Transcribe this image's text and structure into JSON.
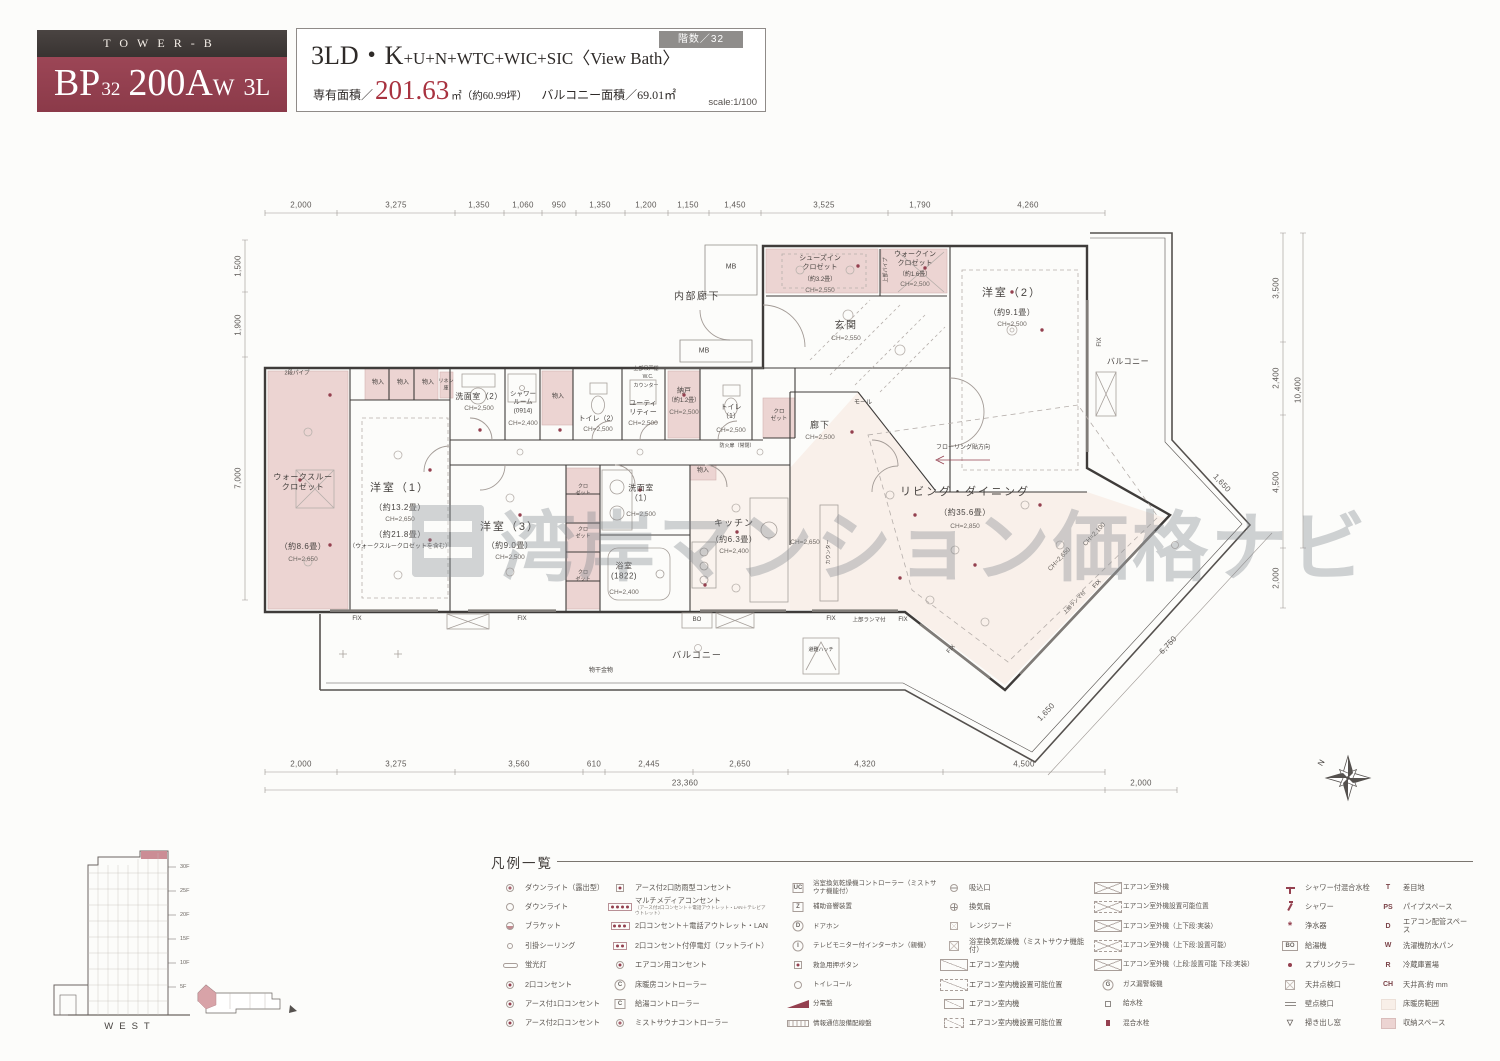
{
  "header": {
    "tower": "TOWER-B",
    "unit_model": "BP",
    "unit_floor": "32",
    "unit_number": "200A",
    "unit_suffix": "W",
    "unit_plan": "3L",
    "floors_badge": "階数／32",
    "title_main": "3LD・K",
    "title_rest": "+U+N+WTC+WIC+SIC",
    "title_view": "〈View Bath〉",
    "area_label": "専有面積／",
    "area_value": "201.63",
    "area_unit": "㎡（約60.99坪）",
    "balcony_area": "バルコニー面積／69.01㎡",
    "scale": "scale:1/100"
  },
  "plan": {
    "watermark": "湾岸マンション価格ナビ",
    "compass_n": "N",
    "rooms": {
      "walkthrough": {
        "name": "ウォークスルー\nクロゼット",
        "size": "（約8.6畳）",
        "ch": "CH=2,650"
      },
      "bed1": {
        "name": "洋室（1）",
        "size": "（約13.2畳）",
        "ch": "CH=2,650",
        "size2": "（約21.8畳）",
        "note": "（ウォークスルークロゼットを含む）"
      },
      "bed2": {
        "name": "洋室（2）",
        "size": "（約9.1畳）",
        "ch": "CH=2,500"
      },
      "bed3": {
        "name": "洋室（3）",
        "size": "（約9.0畳）",
        "ch": "CH=2,500"
      },
      "wash2": {
        "name": "洗面室（2）",
        "ch": "CH=2,500"
      },
      "shower": {
        "name": "シャワー\nルーム\n(0914)",
        "ch": "CH=2,400"
      },
      "toilet2": {
        "name": "トイレ（2）",
        "ch": "CH=2,500"
      },
      "utility": {
        "name": "ユーティ\nリティー",
        "ch": "CH=2,500"
      },
      "storeroom": {
        "name": "納戸",
        "size": "（約1.2畳）",
        "ch": "CH=2,500"
      },
      "toilet1": {
        "name": "トイレ\n（1）",
        "ch": "CH=2,500"
      },
      "wash1": {
        "name": "洗面室\n（1）",
        "ch": "CH=2,500"
      },
      "bath": {
        "name": "浴室\n(1822)",
        "ch": "CH=2,400"
      },
      "kitchen": {
        "name": "キッチン",
        "size": "（約6.3畳）",
        "ch": "CH=2,400"
      },
      "living": {
        "name": "リビング・ダイニング",
        "size": "（約35.6畳）",
        "ch": "CH=2,850"
      },
      "entrance": {
        "name": "玄関",
        "ch": "CH=2,550"
      },
      "corridor": {
        "name": "廊下",
        "ch": "CH=2,500"
      },
      "inner_corridor": {
        "name": "内部廊下"
      },
      "shoes": {
        "name": "シューズイン\nクロゼット",
        "size": "（約3.2畳）",
        "ch": "CH=2,550"
      },
      "wic": {
        "name": "ウォークイン\nクロゼット",
        "size": "（約1.6畳）",
        "ch": "CH=2,500"
      }
    },
    "labels": {
      "balcony": "バルコニー",
      "mb": "MB",
      "mole": "モール",
      "monohoshi": "物干金物",
      "hatch": "避難ハッチ",
      "fix": "FIX",
      "ranma": "上部ランマ付",
      "flooring": "フローリング貼方向",
      "pipe2": "2段パイプ",
      "pipe_up": "上部パイプ",
      "monoire": "物入",
      "closet": "クロ\nゼット",
      "linen": "リネン\n庫",
      "wc": "W.C.",
      "counter": "カウンター",
      "tsurido": "上部吊戸棚",
      "fire_door": "防火扉（常閉）",
      "bo": "BO",
      "island": "カウンター",
      "ch2650": "CH=2,650",
      "ch2100": "CH=2,100"
    },
    "dims": {
      "top": [
        "2,000",
        "3,275",
        "1,350",
        "1,060",
        "950",
        "1,350",
        "1,200",
        "1,150",
        "1,450",
        "3,525",
        "1,790",
        "4,260"
      ],
      "bottom": [
        "2,000",
        "3,275",
        "3,560",
        "610",
        "2,445",
        "2,650",
        "4,320",
        "4,500"
      ],
      "bottom_total": "23,360",
      "bottom_right": "2,000",
      "left": [
        "1,500",
        "1,900",
        "7,000"
      ],
      "right": [
        "3,500",
        "2,400",
        "4,500"
      ],
      "right_total": "10,400",
      "right_bottom": "2,000",
      "diag": [
        "6,750",
        "1,650",
        "1,650"
      ]
    }
  },
  "legend": {
    "title": "凡例一覧",
    "c1": [
      {
        "label": "ダウンライト（露出型）"
      },
      {
        "label": "ダウンライト"
      },
      {
        "label": "ブラケット"
      },
      {
        "label": "引掛シーリング"
      },
      {
        "label": "蛍光灯"
      },
      {
        "label": "2口コンセント"
      },
      {
        "label": "アース付1口コンセント"
      },
      {
        "label": "アース付2口コンセント"
      }
    ],
    "c2": [
      {
        "label": "アース付2口防雨型コンセント"
      },
      {
        "label": "マルチメディアコンセント",
        "sub": "（アース付2口コンセント＋電話アウトレット・LAN＋テレビアウトレット）"
      },
      {
        "label": "2口コンセント＋電話アウトレット・LAN"
      },
      {
        "label": "2口コンセント付停電灯（フットライト）"
      },
      {
        "label": "エアコン用コンセント"
      },
      {
        "label": "床暖房コントローラー",
        "key": "C"
      },
      {
        "label": "給湯コントローラー",
        "key": "C"
      },
      {
        "label": "ミストサウナコントローラー"
      }
    ],
    "c3": [
      {
        "label": "浴室換気乾燥機コントローラー（ミストサウナ機能付）",
        "key": "UC"
      },
      {
        "label": "補助音響装置",
        "key": "Z"
      },
      {
        "label": "ドアホン",
        "key": "D"
      },
      {
        "label": "テレビモニター付インターホン（親機）",
        "key": "I"
      },
      {
        "label": "救急用押ボタン"
      },
      {
        "label": "トイレコール"
      },
      {
        "label": "分電盤"
      },
      {
        "label": "情報通信設備配線盤"
      }
    ],
    "c4": [
      {
        "label": "吸込口"
      },
      {
        "label": "換気扇"
      },
      {
        "label": "レンジフード"
      },
      {
        "label": "浴室換気乾燥機（ミストサウナ機能付）"
      },
      {
        "label": "エアコン室内機"
      },
      {
        "label": "エアコン室内機設置可能位置"
      },
      {
        "label": "エアコン室内機"
      },
      {
        "label": "エアコン室内機設置可能位置"
      }
    ],
    "c5": [
      {
        "label": "エアコン室外機"
      },
      {
        "label": "エアコン室外機設置可能位置"
      },
      {
        "label": "エアコン室外機（上下段:実装）"
      },
      {
        "label": "エアコン室外機（上下段:設置可能）"
      },
      {
        "label": "エアコン室外機（上段:設置可能 下段:実装）"
      },
      {
        "label": "ガス漏警報機",
        "key": "G"
      },
      {
        "label": "給水栓"
      },
      {
        "label": "混合水栓"
      }
    ],
    "c6": [
      {
        "label": "シャワー付混合水栓"
      },
      {
        "label": "シャワー"
      },
      {
        "label": "浄水器"
      },
      {
        "label": "給湯機",
        "key": "BO"
      },
      {
        "label": "スプリンクラー"
      },
      {
        "label": "天井点検口"
      },
      {
        "label": "壁点検口"
      },
      {
        "label": "掃き出し窓"
      }
    ],
    "c7": [
      {
        "label": "差目地",
        "key": "T"
      },
      {
        "label": "パイプスペース",
        "key": "PS"
      },
      {
        "label": "エアコン配管スペース",
        "key": "D"
      },
      {
        "label": "洗濯機防水パン",
        "key": "W"
      },
      {
        "label": "冷蔵庫置場",
        "key": "R"
      },
      {
        "label": "天井高:約 mm",
        "key": "CH"
      },
      {
        "label": "床暖房範囲"
      },
      {
        "label": "収納スペース"
      }
    ]
  },
  "elevation": {
    "caption": "WEST",
    "floors": [
      "30F",
      "25F",
      "20F",
      "15F",
      "10F",
      "5F"
    ]
  }
}
